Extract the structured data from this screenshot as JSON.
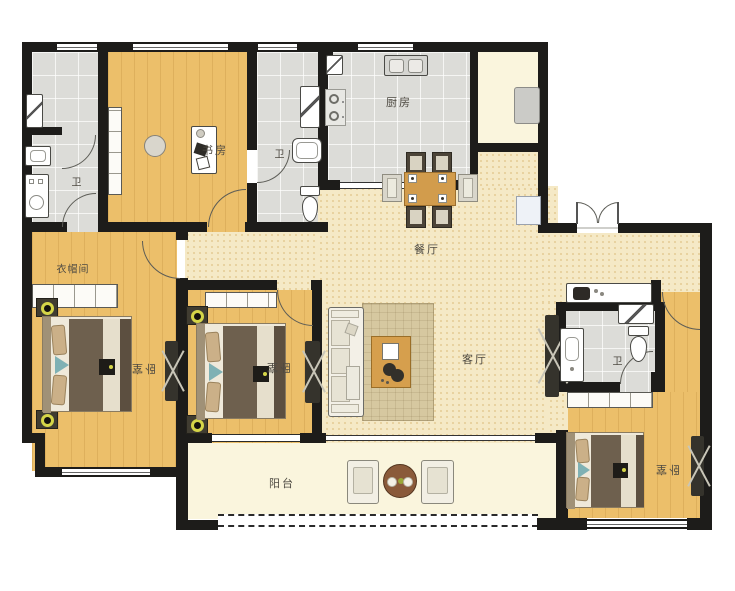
{
  "rooms": {
    "bath_top_left": "卫",
    "study": "书房",
    "bath_mid": "卫",
    "kitchen": "厨房",
    "dining": "餐厅",
    "living": "客厅",
    "cloakroom": "衣帽间",
    "bedroom_left": "卧室",
    "bedroom_mid": "卧室",
    "balcony": "阳台",
    "bath_right": "卫",
    "bedroom_right": "卧室"
  },
  "palette": {
    "wall": "#1d1c1a",
    "wood_floor": "#ecbf6a",
    "tile_floor": "#dcdcd8",
    "hall_floor": "#f5e9c6",
    "balcony_floor": "#faf5dd",
    "label_text": "#4e4a42",
    "table_wood": "#d29c4c",
    "lamp_ring": "#d5d548",
    "radiator": "#35332c"
  }
}
